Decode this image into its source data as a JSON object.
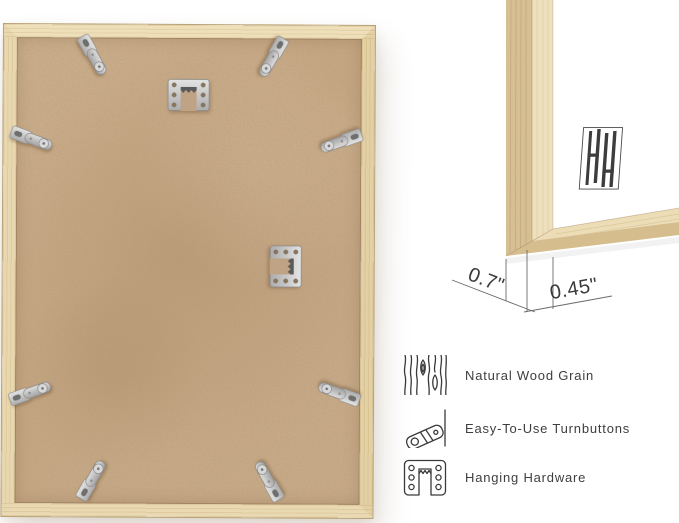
{
  "corner_detail": {
    "brand_logo": "hh-monogram-logo",
    "measurements": {
      "frame_depth": "0.7\"",
      "frame_face_width": "0.45\""
    }
  },
  "back_view": {
    "turnbutton_count": 8,
    "hanger_count": 2
  },
  "features": [
    {
      "icon": "wood-grain-icon",
      "label": "Natural Wood Grain"
    },
    {
      "icon": "turnbutton-icon",
      "label": "Easy-To-Use Turnbuttons"
    },
    {
      "icon": "hanging-hardware-icon",
      "label": "Hanging Hardware"
    }
  ],
  "colors": {
    "wood_light": "#eedfb8",
    "wood_mid": "#e2cfa2",
    "backing_tan": "#c9ab89",
    "metal": "#cfcfcf",
    "annotation_line": "#6b6b6b",
    "annotation_text": "#3a3a3a",
    "feature_text": "#3e3e3e",
    "background": "#ffffff"
  }
}
